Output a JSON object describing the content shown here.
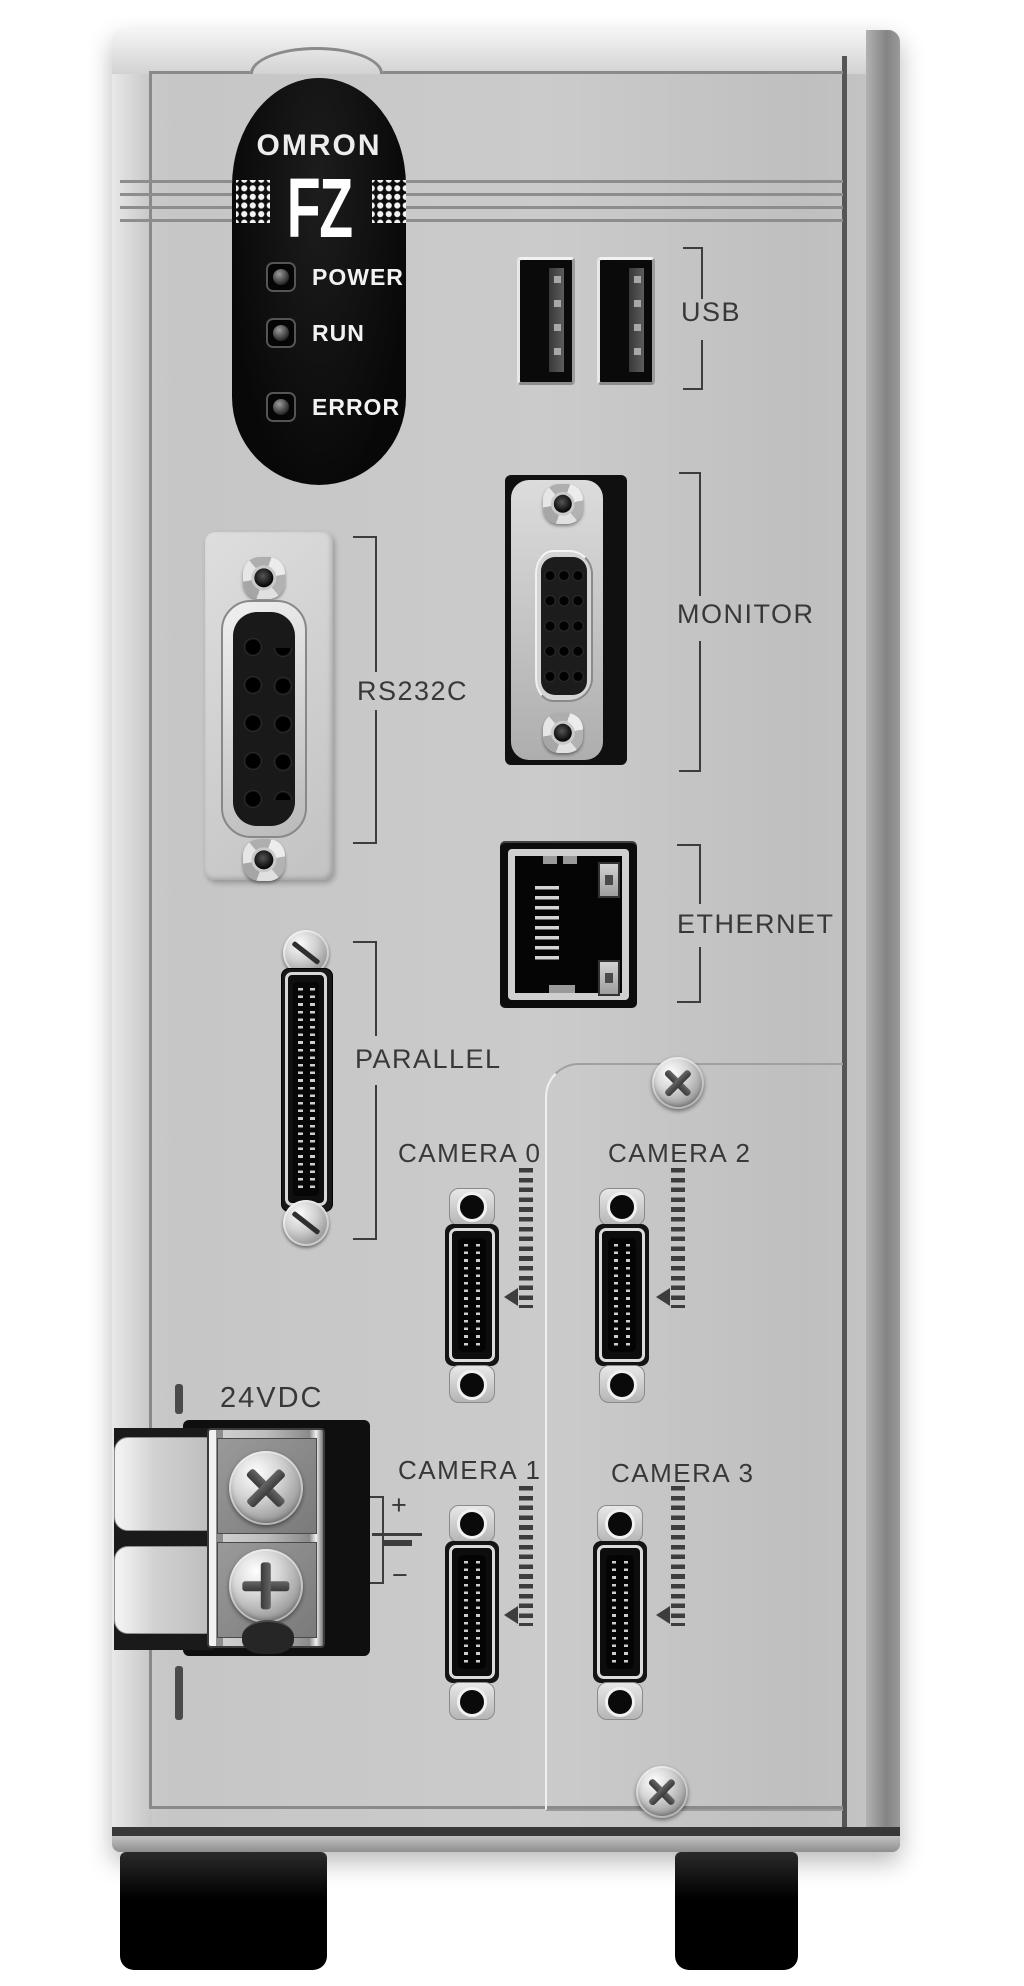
{
  "device": {
    "brand": "OMRON",
    "model": "FZ",
    "leds": [
      {
        "label": "POWER"
      },
      {
        "label": "RUN"
      },
      {
        "label": "ERROR"
      }
    ],
    "ports": {
      "usb": {
        "label": "USB"
      },
      "monitor": {
        "label": "MONITOR"
      },
      "rs232c": {
        "label": "RS232C"
      },
      "ethernet": {
        "label": "ETHERNET"
      },
      "parallel": {
        "label": "PARALLEL"
      },
      "cameras": [
        {
          "label": "CAMERA 0"
        },
        {
          "label": "CAMERA 1"
        },
        {
          "label": "CAMERA 2"
        },
        {
          "label": "CAMERA 3"
        }
      ],
      "power": {
        "label": "24VDC",
        "plus": "+",
        "minus": "−"
      }
    },
    "colors": {
      "panel": "#c9c9c9",
      "badge": "#0f0f0f",
      "label_text": "#383838",
      "led_text": "#f2f2f2",
      "port_black": "#111111",
      "metal": "#d8d8d8"
    }
  }
}
